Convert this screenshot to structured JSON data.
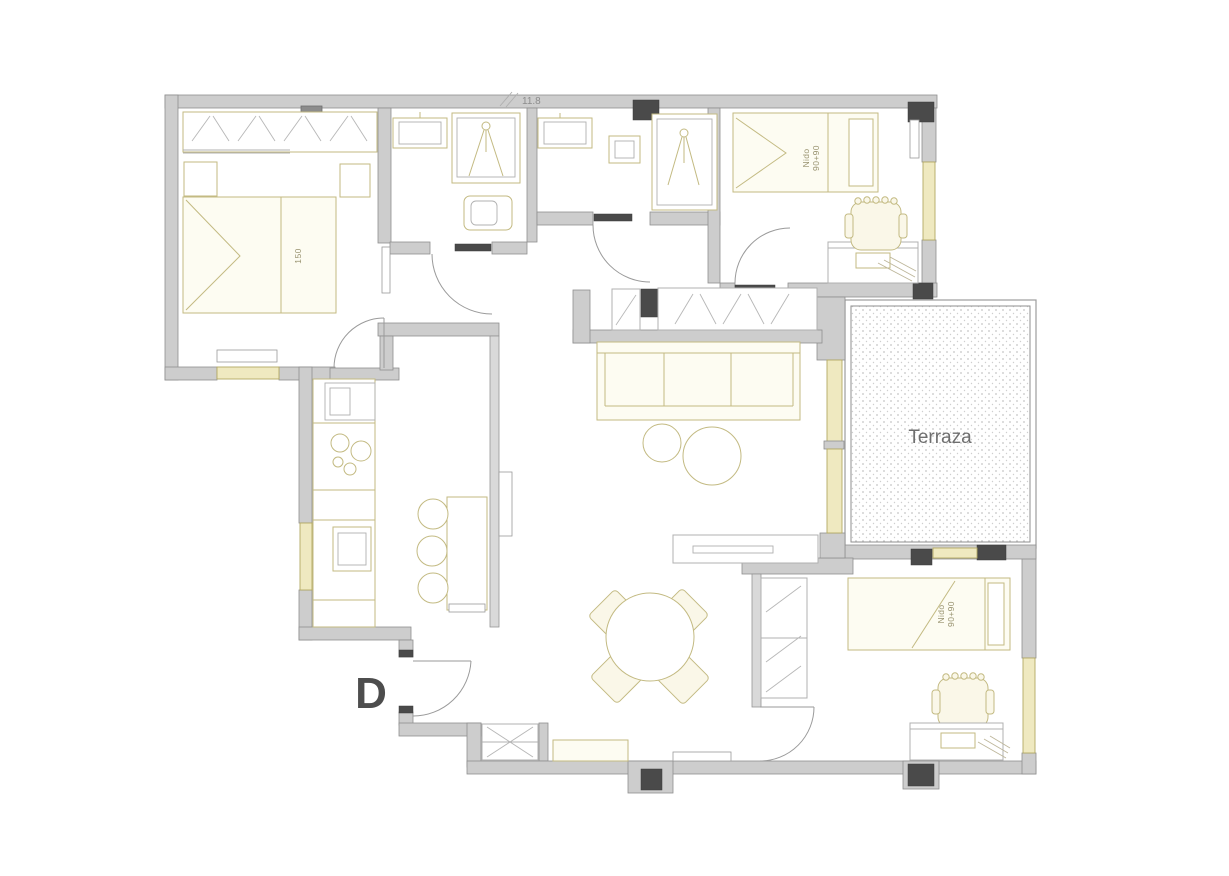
{
  "labels": {
    "terrace": "Terraza",
    "plan_letter": "D",
    "dimension": "11.8",
    "master_bed_width": "150",
    "bed_top": {
      "line1": "Nido",
      "line2": "90+90"
    },
    "bed_bottom": {
      "line1": "Nido",
      "line2": "90+90"
    }
  },
  "colors": {
    "background": "#ffffff",
    "wall_fill": "#cdcdcd",
    "wall_outline": "#8f8f8f",
    "column": "#4a4a4a",
    "furniture_line": "#c3ba82",
    "furniture_fill": "#fdfcf2",
    "fixture_line": "#b0b0b0",
    "window_fill": "#efe9c0",
    "window_line": "#b3a963",
    "terrace_dots": "#c4c4c4",
    "label_text": "#6f6f6f",
    "letter_text": "#4d4d4d"
  }
}
